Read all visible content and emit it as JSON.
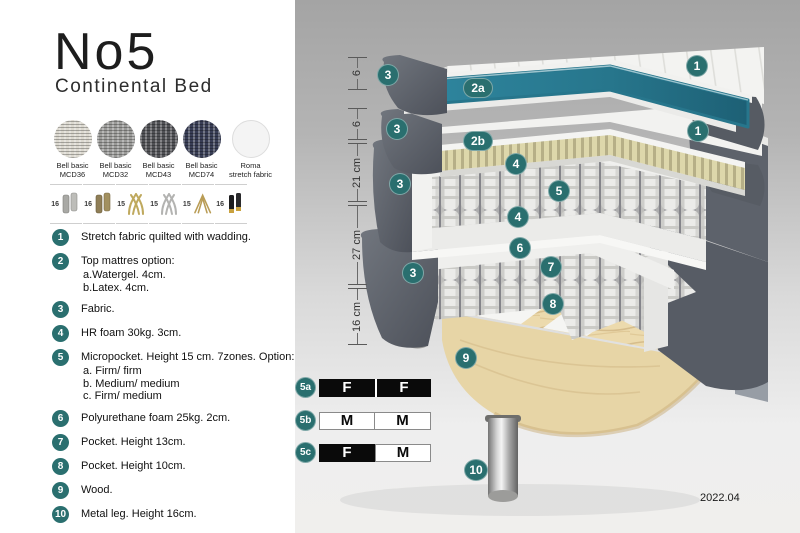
{
  "product": {
    "title": "No5",
    "subtitle": "Continental Bed"
  },
  "swatches": [
    {
      "line1": "Bell basic",
      "line2": "MCD36",
      "color": "#dcd9d0"
    },
    {
      "line1": "Bell basic",
      "line2": "MCD32",
      "color": "#9b9b99"
    },
    {
      "line1": "Bell basic",
      "line2": "MCD43",
      "color": "#515256"
    },
    {
      "line1": "Bell basic",
      "line2": "MCD74",
      "color": "#383d55"
    },
    {
      "line1": "Roma",
      "line2": "stretch fabric",
      "color": "#f4f4f4"
    }
  ],
  "legs": [
    {
      "size": "16",
      "type": "cylinder-silver"
    },
    {
      "size": "16",
      "type": "cylinder-bronze"
    },
    {
      "size": "15",
      "type": "splayed-gold"
    },
    {
      "size": "15",
      "type": "splayed-silver"
    },
    {
      "size": "15",
      "type": "hairpin-gold"
    },
    {
      "size": "16",
      "type": "cylinder-black-gold-tip"
    }
  ],
  "layers": [
    {
      "num": "1",
      "text": "Stretch fabric quilted with wadding."
    },
    {
      "num": "2",
      "text": "Top mattres option:",
      "subs": [
        "a.Watergel. 4cm.",
        "b.Latex. 4cm."
      ]
    },
    {
      "num": "3",
      "text": "Fabric."
    },
    {
      "num": "4",
      "text": "HR foam 30kg. 3cm."
    },
    {
      "num": "5",
      "text": "Micropocket. Height 15 cm. 7zones. Option:",
      "subs": [
        "a. Firm/ firm",
        "b. Medium/ medium",
        "c. Firm/ medium"
      ]
    },
    {
      "num": "6",
      "text": "Polyurethane foam 25kg. 2cm."
    },
    {
      "num": "7",
      "text": "Pocket. Height 13cm."
    },
    {
      "num": "8",
      "text": "Pocket. Height 10cm."
    },
    {
      "num": "9",
      "text": "Wood."
    },
    {
      "num": "10",
      "text": "Metal leg. Height 16cm."
    }
  ],
  "diagram": {
    "ruler": [
      {
        "label": "6"
      },
      {
        "label": "6"
      },
      {
        "label": "21 cm"
      },
      {
        "label": "27 cm"
      },
      {
        "label": "16 cm"
      }
    ],
    "callouts": [
      {
        "label": "1"
      },
      {
        "label": "3"
      },
      {
        "label": "2a"
      },
      {
        "label": "1"
      },
      {
        "label": "3"
      },
      {
        "label": "2b"
      },
      {
        "label": "4"
      },
      {
        "label": "5"
      },
      {
        "label": "3"
      },
      {
        "label": "4"
      },
      {
        "label": "6"
      },
      {
        "label": "7"
      },
      {
        "label": "3"
      },
      {
        "label": "8"
      },
      {
        "label": "9"
      },
      {
        "label": "10"
      }
    ],
    "firmness": [
      {
        "label": "5a",
        "cells": [
          "F",
          "F"
        ]
      },
      {
        "label": "5b",
        "cells": [
          "M",
          "M"
        ]
      },
      {
        "label": "5c",
        "cells": [
          "F",
          "M"
        ]
      }
    ],
    "version": "2022.04"
  },
  "colors": {
    "accent_teal": "#2a6f6f",
    "watergel_teal": "#2b7e93",
    "latex_cream": "#d9d3a8",
    "fabric_gray": "#5a5f67",
    "wood": "#e9d7aa"
  }
}
